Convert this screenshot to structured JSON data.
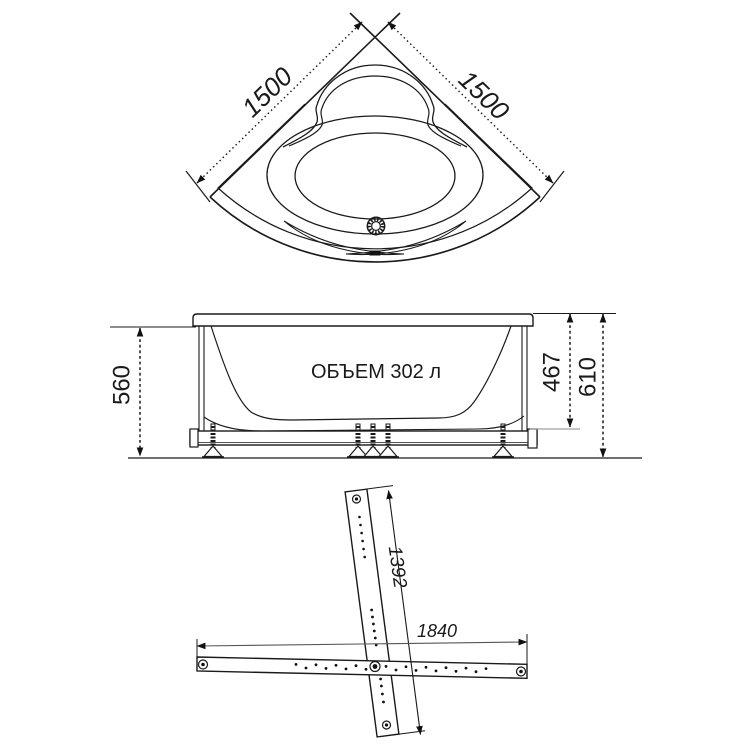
{
  "drawing": {
    "top_view": {
      "dim_left": "1500",
      "dim_right": "1500"
    },
    "side_view": {
      "volume_label": "ОБЪЕМ 302 л",
      "height_left": "560",
      "height_inner": "467",
      "height_total": "610"
    },
    "frame_view": {
      "cross_rail_length": "1392",
      "main_rail_length": "1840"
    },
    "colors": {
      "line": "#1a1a1a",
      "background": "#ffffff"
    }
  }
}
